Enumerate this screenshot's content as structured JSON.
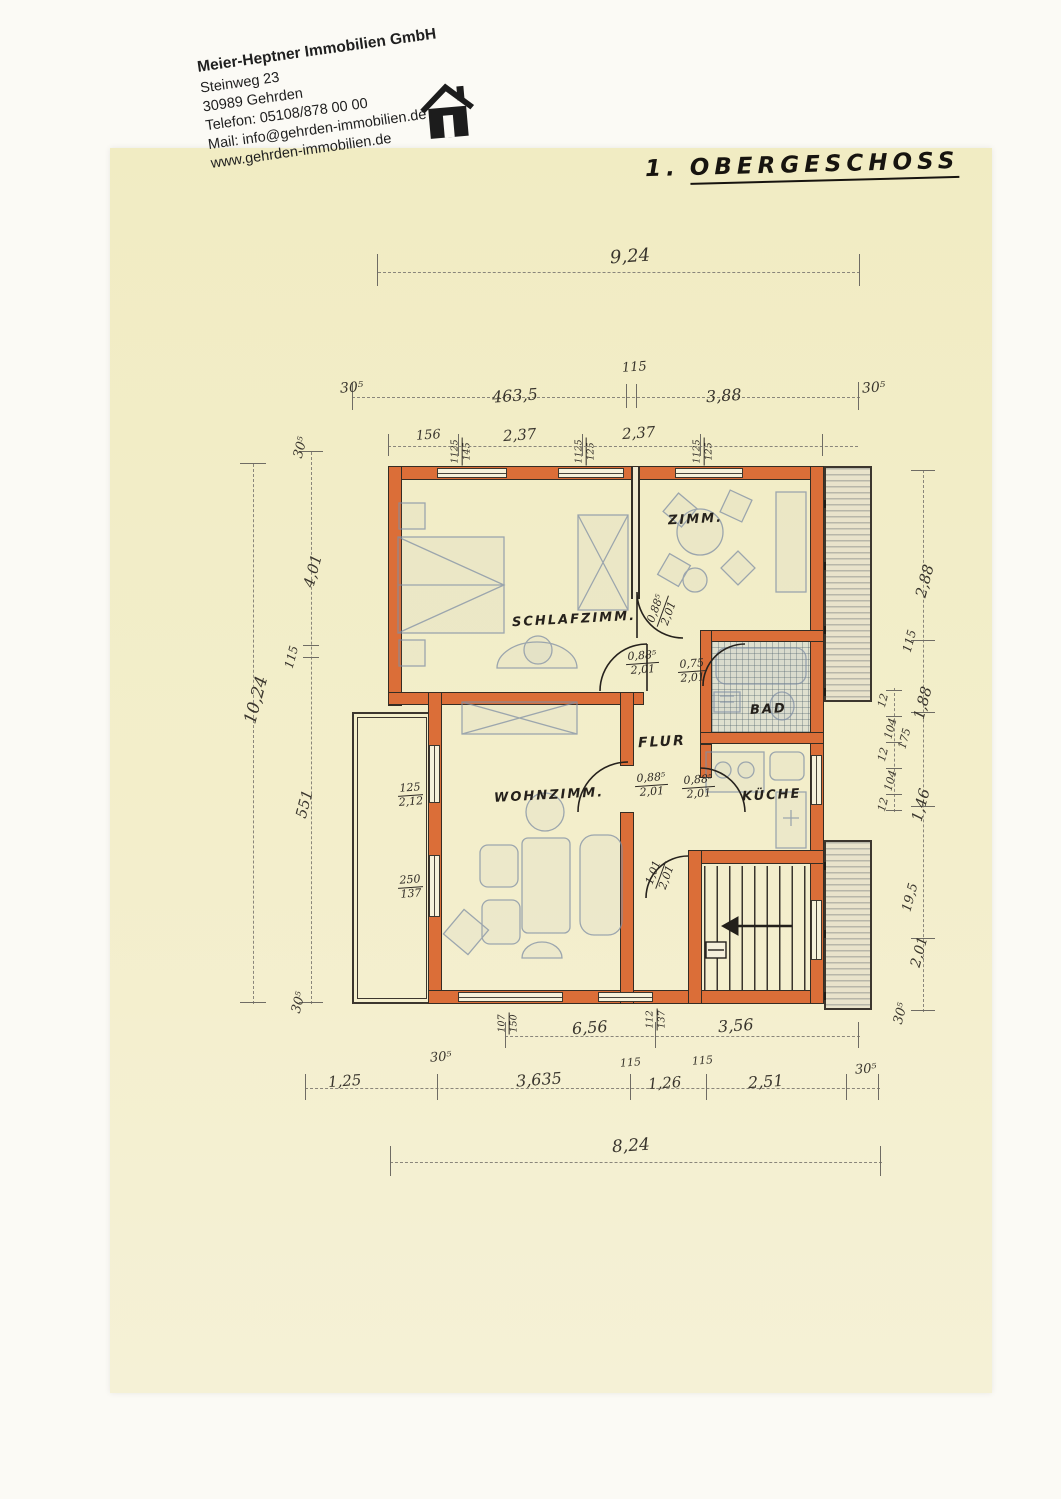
{
  "letterhead": {
    "company": "Meier-Heptner Immobilien GmbH",
    "street": "Steinweg 23",
    "city": "30989 Gehrden",
    "phone": "Telefon: 05108/878 00 00",
    "mail": "Mail: info@gehrden-immobilien.de",
    "web": "www.gehrden-immobilien.de"
  },
  "title": {
    "prefix": "1.",
    "text": "OBERGESCHOSS"
  },
  "rooms": {
    "schlafzimmer": "SCHLAFZIMM.",
    "zimmer": "ZIMM.",
    "bad": "BAD",
    "flur": "FLUR",
    "wohnzimmer": "WOHNZIMM.",
    "kueche": "KÜCHE"
  },
  "doors": {
    "schlafzimmer": {
      "w": "0,88⁵",
      "h": "2,01"
    },
    "zimmer": {
      "w": "0,88⁵",
      "h": "2,01"
    },
    "bad": {
      "w": "0,75",
      "h": "2,01"
    },
    "wohnzimmer": {
      "w": "0,88⁵",
      "h": "2,01"
    },
    "kueche": {
      "w": "0,88⁵",
      "h": "2,01"
    },
    "treppe": {
      "w": "1,01",
      "h": "2,01"
    }
  },
  "windows": {
    "top1": {
      "w": "1125",
      "h": "145"
    },
    "top2": {
      "w": "1125",
      "h": "125"
    },
    "top3": {
      "w": "1125",
      "h": "125"
    },
    "left1": {
      "w": "125",
      "h": "2,12"
    },
    "left2": {
      "w": "250",
      "h": "137"
    },
    "bottom1": {
      "w": "107",
      "h": "150"
    },
    "bottom2": {
      "w": "112",
      "h": "137"
    }
  },
  "dims": {
    "top_overall": "9,24",
    "top_115": "115",
    "top_305_l": "30⁵",
    "top_4635": "463,5",
    "top_388": "3,88",
    "top_305_r": "30⁵",
    "top_156": "156",
    "top_237_a": "2,37",
    "top_237_b": "2,37",
    "left_overall": "10,24",
    "left_305_t": "30⁵",
    "left_401": "4,01",
    "left_115": "115",
    "left_551": "551",
    "left_305_b": "30⁵",
    "right_288": "2,88",
    "right_115": "115",
    "right_188": "1,88",
    "right_175": "175",
    "right_12_a": "12",
    "right_104_a": "104",
    "right_12_b": "12",
    "right_104_b": "104",
    "right_12_c": "12",
    "right_146": "1,46",
    "right_195": "19,5",
    "right_201": "2,01",
    "right_305": "30⁵",
    "bottom_656": "6,56",
    "bottom_356": "3,56",
    "bottom_125": "1,25",
    "bottom_305_a": "30⁵",
    "bottom_3635": "3,635",
    "bottom_115_a": "115",
    "bottom_126": "1,26",
    "bottom_115_b": "115",
    "bottom_251": "2,51",
    "bottom_305_b": "30⁵",
    "bottom_overall": "8,24"
  },
  "colors": {
    "paper": "#f2edc6",
    "wall": "#db6e38",
    "ink": "#2e2a25",
    "tile": "#dfe0cf"
  }
}
